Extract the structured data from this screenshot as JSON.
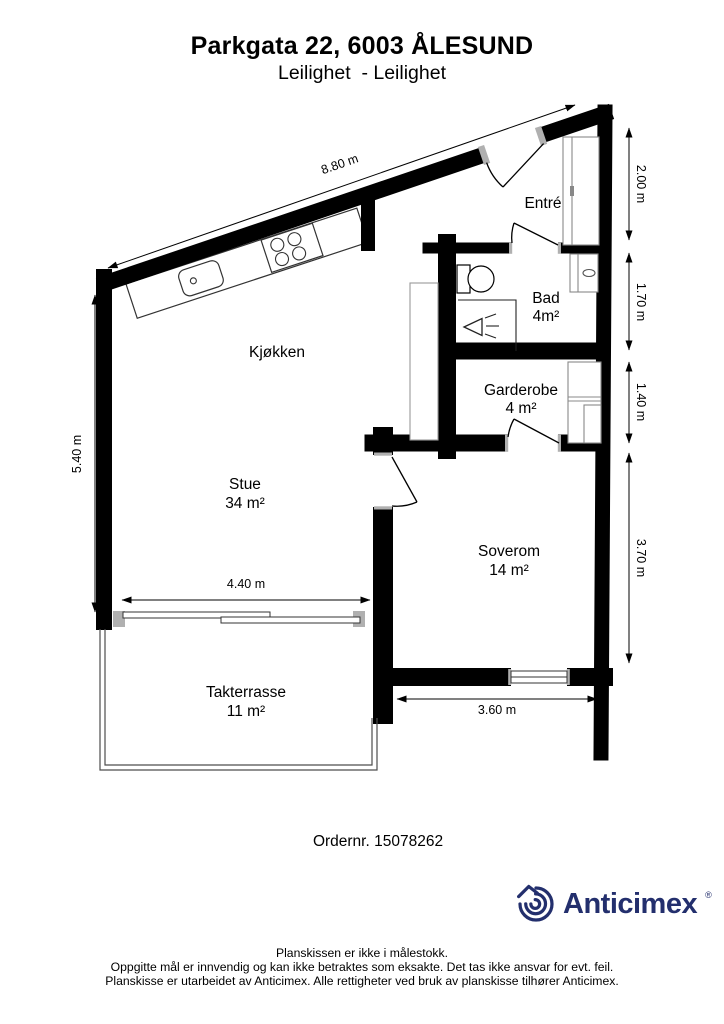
{
  "header": {
    "title": "Parkgata 22, 6003 ÅLESUND",
    "subtitle": "Leilighet  - Leilighet"
  },
  "floorplan": {
    "rooms": {
      "entre": {
        "name": "Entré"
      },
      "bad": {
        "name": "Bad",
        "area": "4m²"
      },
      "garderobe": {
        "name": "Garderobe",
        "area": "4 m²"
      },
      "kjokken": {
        "name": "Kjøkken"
      },
      "stue": {
        "name": "Stue",
        "area": "34 m²"
      },
      "soverom": {
        "name": "Soverom",
        "area": "14 m²"
      },
      "takterrasse": {
        "name": "Takterrasse",
        "area": "11 m²"
      }
    },
    "dimensions": {
      "top_diagonal": "8.80 m",
      "left_height": "5.40 m",
      "right_entre": "2.00 m",
      "right_bad": "1.70 m",
      "right_garderobe": "1.40 m",
      "right_soverom": "3.70 m",
      "stue_width": "4.40 m",
      "soverom_width": "3.60 m"
    }
  },
  "footer": {
    "order_number": "Ordernr. 15078262",
    "logo_text": "Anticimex",
    "logo_registered": "®",
    "disclaimer_line1": "Planskissen er ikke i målestokk.",
    "disclaimer_line2": "Oppgitte mål er innvendig og kan ikke betraktes som eksakte. Det tas ikke ansvar for evt. feil.",
    "disclaimer_line3": "Planskisse er utarbeidet av Anticimex. Alle rettigheter ved bruk av planskisse tilhører Anticimex."
  },
  "colors": {
    "wall": "#000000",
    "logo_navy": "#232f6d",
    "background": "#ffffff"
  }
}
